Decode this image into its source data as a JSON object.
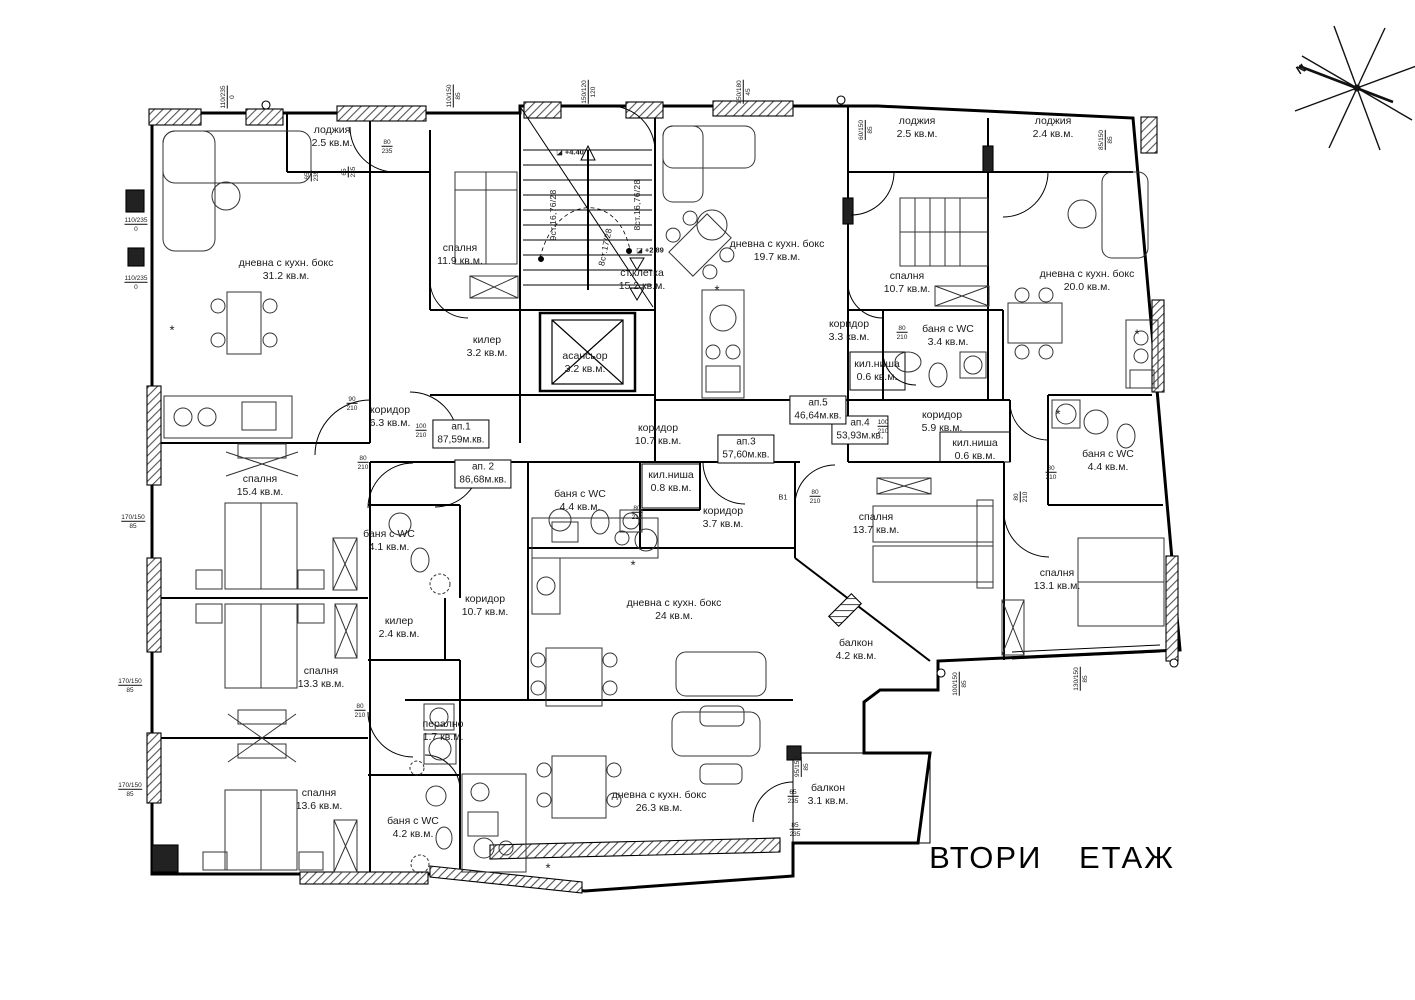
{
  "title": {
    "text": "ВТОРИ ЕТАЖ"
  },
  "compass": {
    "north_label": "N"
  },
  "floor_plan": {
    "rooms": [
      {
        "name": "лоджия",
        "area": "2.5 кв.м.",
        "x": 332,
        "y": 137
      },
      {
        "name": "дневна с кухн. бокс",
        "area": "31.2 кв.м.",
        "x": 286,
        "y": 270
      },
      {
        "name": "спалня",
        "area": "11.9 кв.м.",
        "x": 460,
        "y": 255
      },
      {
        "name": "килер",
        "area": "3.2 кв.м.",
        "x": 487,
        "y": 347
      },
      {
        "name": "ст.клетка",
        "area": "15.2 кв.м.",
        "x": 642,
        "y": 280
      },
      {
        "name": "асансьор",
        "area": "3.2 кв.м.",
        "x": 585,
        "y": 363
      },
      {
        "name": "дневна с кухн. бокс",
        "area": "19.7 кв.м.",
        "x": 777,
        "y": 251
      },
      {
        "name": "коридор",
        "area": "3.3 кв.м.",
        "x": 849,
        "y": 331
      },
      {
        "name": "кил.ниша",
        "area": "0.6 кв.м.",
        "x": 877,
        "y": 371
      },
      {
        "name": "лоджия",
        "area": "2.5 кв.м.",
        "x": 917,
        "y": 128
      },
      {
        "name": "лоджия",
        "area": "2.4 кв.м.",
        "x": 1053,
        "y": 128
      },
      {
        "name": "спалня",
        "area": "10.7 кв.м.",
        "x": 907,
        "y": 283
      },
      {
        "name": "дневна с кухн. бокс",
        "area": "20.0 кв.м.",
        "x": 1087,
        "y": 281
      },
      {
        "name": "баня с WC",
        "area": "3.4 кв.м.",
        "x": 948,
        "y": 336
      },
      {
        "name": "коридор",
        "area": "6.3 кв.м.",
        "x": 390,
        "y": 417
      },
      {
        "name": "коридор",
        "area": "10.7 кв.м.",
        "x": 658,
        "y": 435
      },
      {
        "name": "коридор",
        "area": "5.9 кв.м.",
        "x": 942,
        "y": 422
      },
      {
        "name": "кил.ниша",
        "area": "0.6 кв.м.",
        "x": 975,
        "y": 450
      },
      {
        "name": "баня с WC",
        "area": "4.4 кв.м.",
        "x": 1108,
        "y": 461
      },
      {
        "name": "баня с WC",
        "area": "4.4 кв.м.",
        "x": 580,
        "y": 501
      },
      {
        "name": "кил.ниша",
        "area": "0.8 кв.м.",
        "x": 671,
        "y": 482
      },
      {
        "name": "коридор",
        "area": "3.7 кв.м.",
        "x": 723,
        "y": 518
      },
      {
        "name": "спалня",
        "area": "15.4 кв.м.",
        "x": 260,
        "y": 486
      },
      {
        "name": "баня с WC",
        "area": "4.1 кв.м.",
        "x": 389,
        "y": 541
      },
      {
        "name": "коридор",
        "area": "10.7 кв.м.",
        "x": 485,
        "y": 606
      },
      {
        "name": "килер",
        "area": "2.4 кв.м.",
        "x": 399,
        "y": 628
      },
      {
        "name": "дневна с кухн. бокс",
        "area": "24 кв.м.",
        "x": 674,
        "y": 610
      },
      {
        "name": "спалня",
        "area": "13.3 кв.м.",
        "x": 321,
        "y": 678
      },
      {
        "name": "спалня",
        "area": "13.7 кв.м.",
        "x": 876,
        "y": 524
      },
      {
        "name": "спалня",
        "area": "13.1 кв.м.",
        "x": 1057,
        "y": 580
      },
      {
        "name": "балкон",
        "area": "4.2 кв.м.",
        "x": 856,
        "y": 650
      },
      {
        "name": "спалня",
        "area": "13.6 кв.м.",
        "x": 319,
        "y": 800
      },
      {
        "name": "баня с WC",
        "area": "4.2 кв.м.",
        "x": 413,
        "y": 828
      },
      {
        "name": "перално",
        "area": "1.7 кв.м.",
        "x": 443,
        "y": 731
      },
      {
        "name": "дневна с кухн. бокс",
        "area": "26.3 кв.м.",
        "x": 659,
        "y": 802
      },
      {
        "name": "балкон",
        "area": "3.1 кв.м.",
        "x": 828,
        "y": 795
      }
    ],
    "apartments": [
      {
        "label": "ап.1",
        "area": "87,59м.кв.",
        "x": 461,
        "y": 434
      },
      {
        "label": "ап. 2",
        "area": "86,68м.кв.",
        "x": 483,
        "y": 474
      },
      {
        "label": "ап.3",
        "area": "57,60м.кв.",
        "x": 746,
        "y": 449
      },
      {
        "label": "ап.4",
        "area": "53,93м.кв.",
        "x": 860,
        "y": 430
      },
      {
        "label": "ап.5",
        "area": "46,64м.кв.",
        "x": 818,
        "y": 410
      }
    ],
    "stairs": [
      {
        "text": "9ст.16,76/28",
        "x": 553,
        "y": 215,
        "rot": -90
      },
      {
        "text": "8ст.17/28",
        "x": 605,
        "y": 247,
        "rot": -78
      },
      {
        "text": "8ст.16,76/28",
        "x": 637,
        "y": 205,
        "rot": -90
      }
    ],
    "elevations": [
      {
        "text": "+4.40",
        "x": 570,
        "y": 152
      },
      {
        "text": "+2.89",
        "x": 650,
        "y": 250
      }
    ],
    "dimensions": [
      {
        "w": "110/235",
        "h": "0",
        "x": 136,
        "y": 225,
        "rot": 0
      },
      {
        "w": "110/235",
        "h": "0",
        "x": 136,
        "y": 283,
        "rot": 0
      },
      {
        "w": "170/150",
        "h": "85",
        "x": 133,
        "y": 522,
        "rot": 0
      },
      {
        "w": "170/150",
        "h": "85",
        "x": 130,
        "y": 686,
        "rot": 0
      },
      {
        "w": "170/150",
        "h": "85",
        "x": 130,
        "y": 790,
        "rot": 0
      },
      {
        "w": "110/235",
        "h": "0",
        "x": 228,
        "y": 97,
        "rot": -90
      },
      {
        "w": "110/150",
        "h": "85",
        "x": 454,
        "y": 96,
        "rot": -90
      },
      {
        "w": "150/120",
        "h": "120",
        "x": 589,
        "y": 92,
        "rot": -90
      },
      {
        "w": "250/180",
        "h": "45",
        "x": 744,
        "y": 92,
        "rot": -90
      },
      {
        "w": "60/150",
        "h": "85",
        "x": 866,
        "y": 130,
        "rot": -90
      },
      {
        "w": "85/150",
        "h": "85",
        "x": 1106,
        "y": 140,
        "rot": -90
      },
      {
        "w": "65",
        "h": "235",
        "x": 312,
        "y": 176,
        "rot": -90
      },
      {
        "w": "65",
        "h": "235",
        "x": 349,
        "y": 172,
        "rot": -90
      },
      {
        "w": "80",
        "h": "235",
        "x": 387,
        "y": 147,
        "rot": 0
      },
      {
        "w": "90",
        "h": "210",
        "x": 352,
        "y": 404,
        "rot": 0
      },
      {
        "w": "100",
        "h": "210",
        "x": 421,
        "y": 431,
        "rot": 0
      },
      {
        "w": "80",
        "h": "210",
        "x": 363,
        "y": 463,
        "rot": 0
      },
      {
        "w": "80",
        "h": "210",
        "x": 637,
        "y": 513,
        "rot": 0
      },
      {
        "w": "80",
        "h": "210",
        "x": 815,
        "y": 497,
        "rot": 0
      },
      {
        "w": "100",
        "h": "210",
        "x": 883,
        "y": 427,
        "rot": 0
      },
      {
        "w": "80",
        "h": "210",
        "x": 1051,
        "y": 473,
        "rot": 0
      },
      {
        "w": "80",
        "h": "210",
        "x": 360,
        "y": 711,
        "rot": 0
      },
      {
        "w": "80",
        "h": "210",
        "x": 902,
        "y": 333,
        "rot": 0
      },
      {
        "w": "80",
        "h": "210",
        "x": 1021,
        "y": 497,
        "rot": -90
      },
      {
        "w": "95/150",
        "h": "85",
        "x": 802,
        "y": 767,
        "rot": -90
      },
      {
        "w": "100/150",
        "h": "85",
        "x": 960,
        "y": 684,
        "rot": -90
      },
      {
        "w": "130/150",
        "h": "85",
        "x": 1081,
        "y": 679,
        "rot": -90
      },
      {
        "w": "65",
        "h": "235",
        "x": 793,
        "y": 797,
        "rot": 0
      },
      {
        "w": "85",
        "h": "235",
        "x": 795,
        "y": 830,
        "rot": 0
      }
    ],
    "annotations": [
      {
        "text": "B1",
        "x": 783,
        "y": 497
      },
      {
        "text": "*",
        "x": 172,
        "y": 330,
        "star": true
      },
      {
        "text": "*",
        "x": 633,
        "y": 565,
        "star": true
      },
      {
        "text": "*",
        "x": 548,
        "y": 868,
        "star": true
      },
      {
        "text": "*",
        "x": 1058,
        "y": 414,
        "star": true
      },
      {
        "text": "*",
        "x": 717,
        "y": 290,
        "star": true
      },
      {
        "text": "*",
        "x": 1137,
        "y": 334,
        "star": true
      }
    ]
  }
}
